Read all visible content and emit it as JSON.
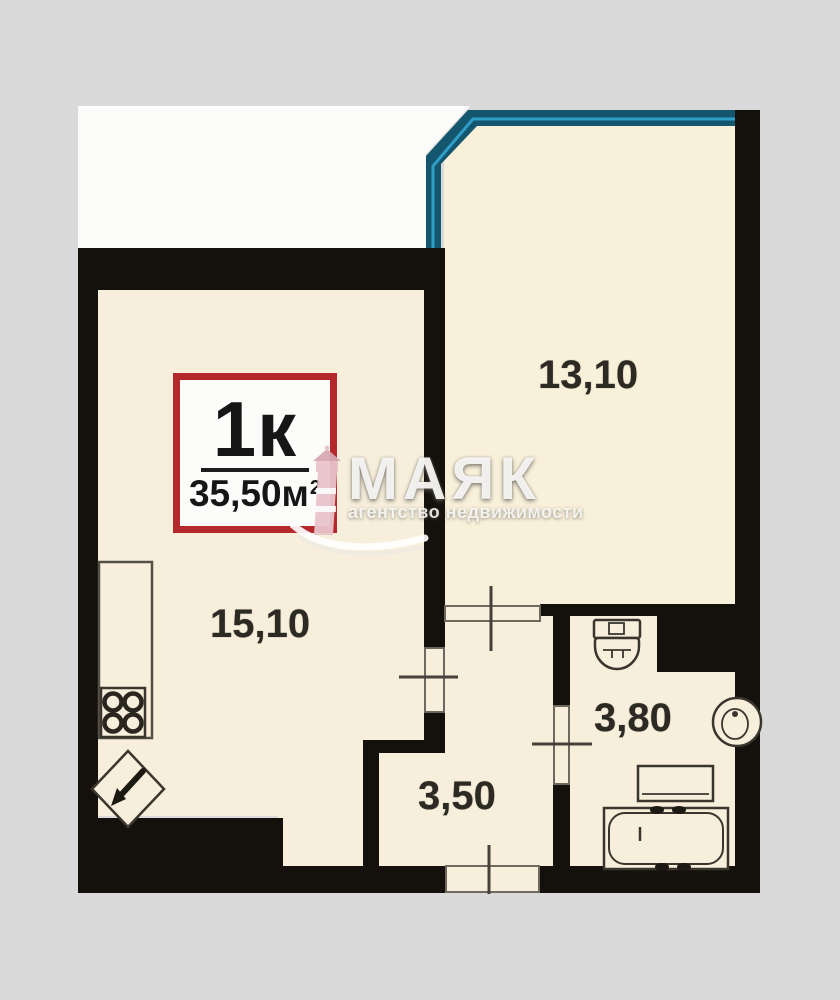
{
  "page": {
    "background_color": "#dadada"
  },
  "plan": {
    "badge": {
      "type_label": "1к",
      "area_label": "35,50м",
      "area_superscript": "2",
      "border_color": "#b5292d"
    },
    "rooms": [
      {
        "name": "kitchen-living-room",
        "area_label": "15,10"
      },
      {
        "name": "bedroom",
        "area_label": "13,10"
      },
      {
        "name": "bathroom",
        "area_label": "3,80"
      },
      {
        "name": "hallway",
        "area_label": "3,50"
      }
    ],
    "colors": {
      "wall": "#14100c",
      "floor": "#f7efdb",
      "window_blue": "#1692d4",
      "window_teal": "#14566e",
      "background_white": "#fbfbfa",
      "badge_red": "#b5292d"
    }
  },
  "watermark": {
    "brand": "МАЯК",
    "tagline": "агентство недвижимости"
  }
}
